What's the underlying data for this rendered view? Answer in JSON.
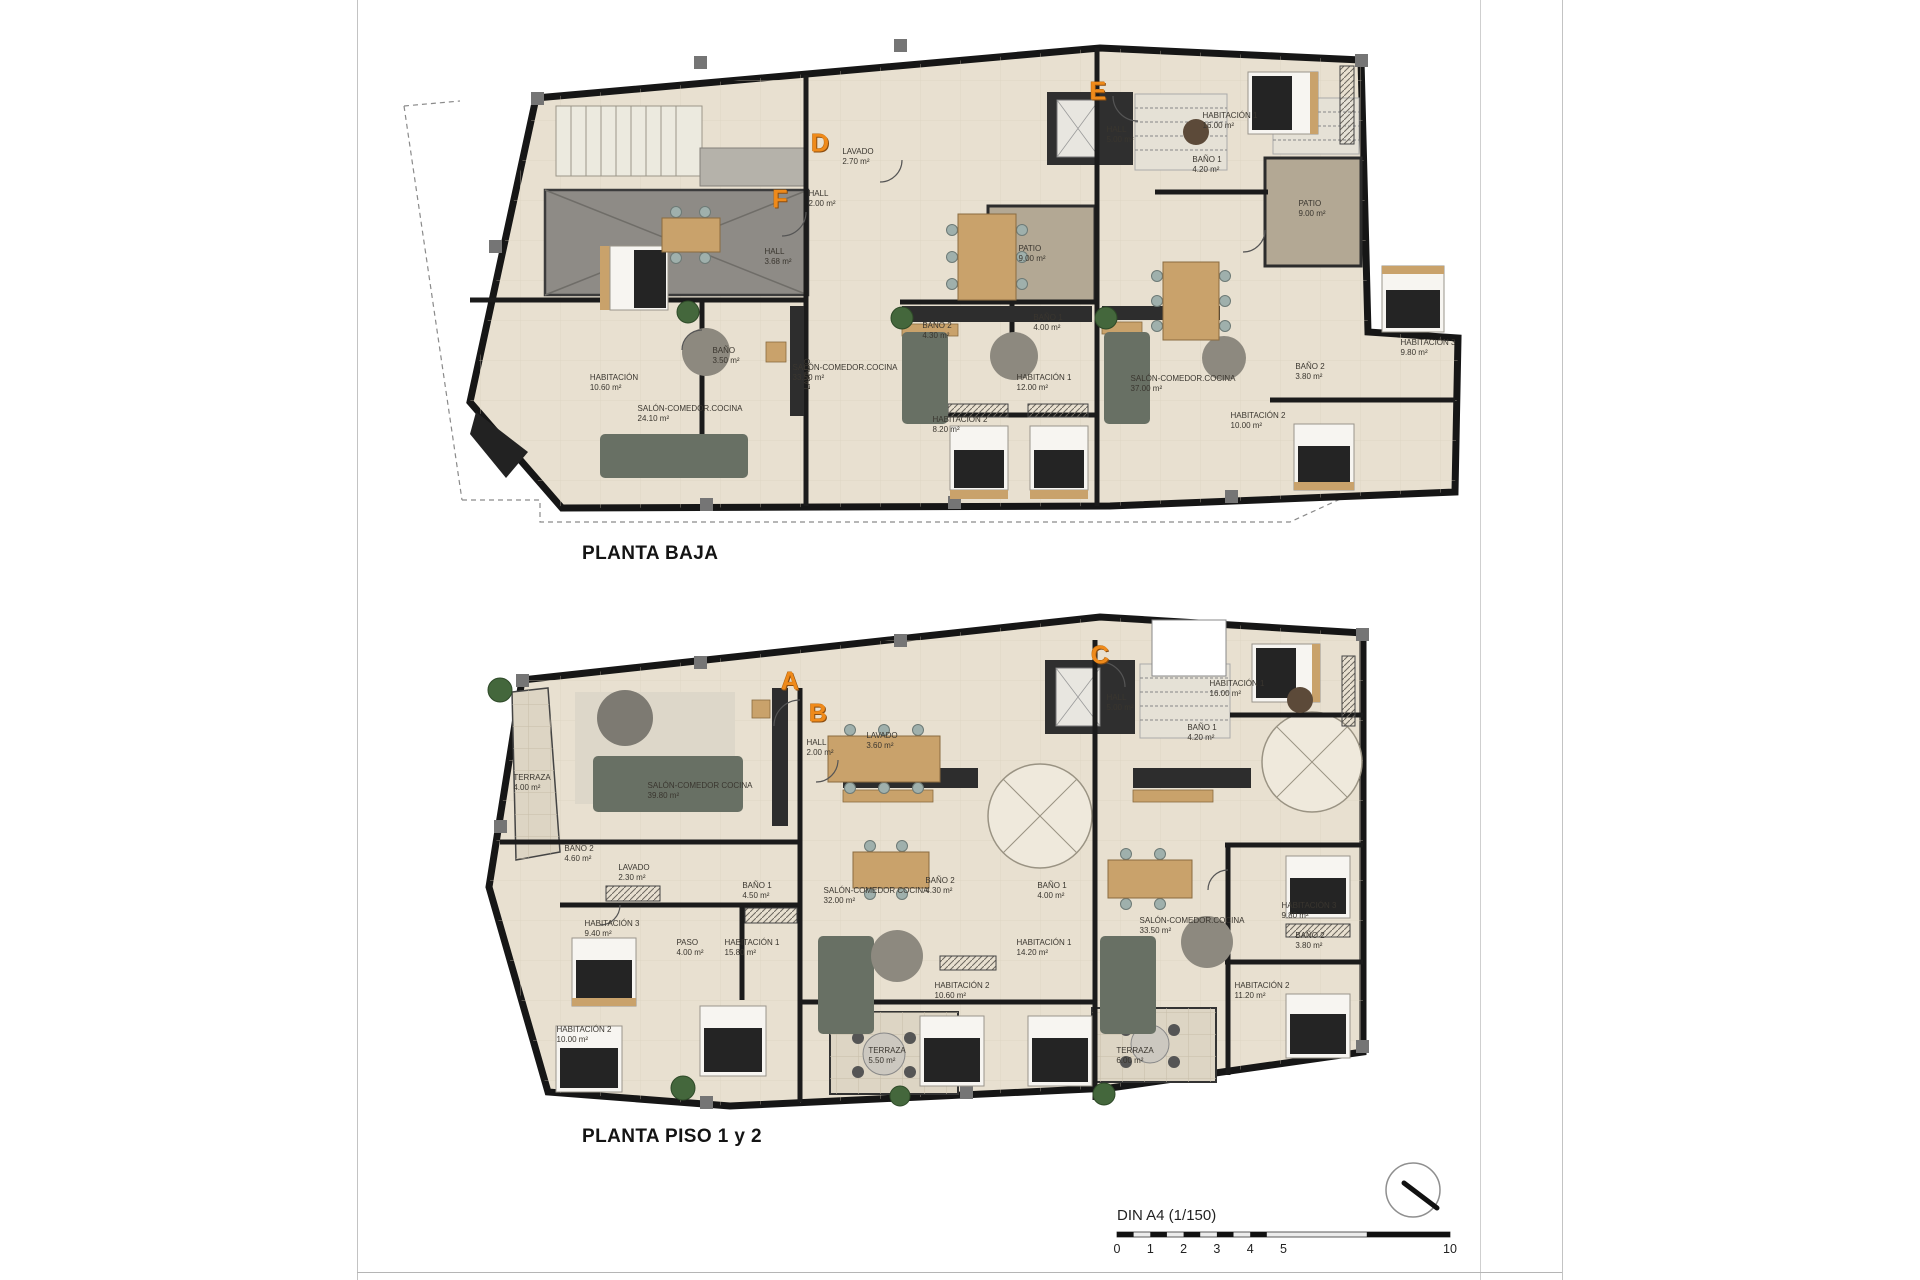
{
  "document": {
    "sections": [
      {
        "id": "planta-baja",
        "title": "PLANTA BAJA"
      },
      {
        "id": "planta-piso",
        "title": "PLANTA PISO 1 y 2"
      }
    ],
    "scale": {
      "label": "DIN A4 (1/150)",
      "ticks": [
        {
          "t": "0",
          "u": 0
        },
        {
          "t": "1",
          "u": 1
        },
        {
          "t": "2",
          "u": 2
        },
        {
          "t": "3",
          "u": 3
        },
        {
          "t": "4",
          "u": 4
        },
        {
          "t": "5",
          "u": 5
        },
        {
          "t": "10",
          "u": 10
        }
      ]
    },
    "colors": {
      "marker_orange": "#ef8a1a",
      "floor_beige": "#e8e0d0",
      "wall_dark": "#1b1b1b",
      "patio_tan": "#b3a894",
      "terrace_tile": "#ddd5c4",
      "garage_gray": "#8e8b86"
    }
  },
  "plans": [
    {
      "name": "planta-baja",
      "markers": [
        {
          "letter": "F",
          "x": 780,
          "y": 200
        },
        {
          "letter": "D",
          "x": 820,
          "y": 144
        },
        {
          "letter": "E",
          "x": 1098,
          "y": 92
        }
      ],
      "rooms": [
        {
          "name": "HALL",
          "area": "3.68 m²",
          "x": 778,
          "y": 257
        },
        {
          "name": "BAÑO",
          "area": "3.50 m²",
          "x": 726,
          "y": 356
        },
        {
          "name": "HABITACIÓN",
          "area": "10.60 m²",
          "x": 614,
          "y": 383
        },
        {
          "name": "SALÓN-COMEDOR.COCINA",
          "area": "24.10 m²",
          "x": 690,
          "y": 414
        },
        {
          "name": "LAVADO",
          "area": "",
          "x": 808,
          "y": 374,
          "v": true
        },
        {
          "name": "LAVADO",
          "area": "2.70 m²",
          "x": 858,
          "y": 157
        },
        {
          "name": "HALL",
          "area": "2.00 m²",
          "x": 822,
          "y": 199
        },
        {
          "name": "PATIO",
          "area": "9.00 m²",
          "x": 1032,
          "y": 254
        },
        {
          "name": "BAÑO 2",
          "area": "4.30 m²",
          "x": 937,
          "y": 331
        },
        {
          "name": "BAÑO 1",
          "area": "4.00 m²",
          "x": 1048,
          "y": 323
        },
        {
          "name": "SALÓN-COMEDOR.COCINA",
          "area": "33.50 m²",
          "x": 845,
          "y": 373
        },
        {
          "name": "HABITACIÓN 1",
          "area": "12.00 m²",
          "x": 1044,
          "y": 383
        },
        {
          "name": "HABITACIÓN 2",
          "area": "8.20 m²",
          "x": 960,
          "y": 425
        },
        {
          "name": "HALL",
          "area": "5.00 m²",
          "x": 1120,
          "y": 135
        },
        {
          "name": "HABITACIÓN 1",
          "area": "16.00 m²",
          "x": 1230,
          "y": 121
        },
        {
          "name": "BAÑO 1",
          "area": "4.20 m²",
          "x": 1207,
          "y": 165
        },
        {
          "name": "PATIO",
          "area": "9.00 m²",
          "x": 1312,
          "y": 209
        },
        {
          "name": "HABITACIÓN 3",
          "area": "9.80 m²",
          "x": 1428,
          "y": 348
        },
        {
          "name": "BAÑO 2",
          "area": "3.80 m²",
          "x": 1310,
          "y": 372
        },
        {
          "name": "SALÓN-COMEDOR.COCINA",
          "area": "37.00 m²",
          "x": 1183,
          "y": 384
        },
        {
          "name": "HABITACIÓN 2",
          "area": "10.00 m²",
          "x": 1258,
          "y": 421
        }
      ]
    },
    {
      "name": "planta-piso",
      "markers": [
        {
          "letter": "A",
          "x": 790,
          "y": 682
        },
        {
          "letter": "B",
          "x": 818,
          "y": 714
        },
        {
          "letter": "C",
          "x": 1100,
          "y": 656
        }
      ],
      "rooms": [
        {
          "name": "TERRAZA",
          "area": "4.00 m²",
          "x": 532,
          "y": 783
        },
        {
          "name": "SALÓN-COMEDOR COCINA",
          "area": "39.80 m²",
          "x": 700,
          "y": 791
        },
        {
          "name": "BAÑO 2",
          "area": "4.60 m²",
          "x": 579,
          "y": 854
        },
        {
          "name": "LAVADO",
          "area": "2.30 m²",
          "x": 634,
          "y": 873
        },
        {
          "name": "BAÑO 1",
          "area": "4.50 m²",
          "x": 757,
          "y": 891
        },
        {
          "name": "HABITACIÓN 3",
          "area": "9.40 m²",
          "x": 612,
          "y": 929
        },
        {
          "name": "PASO",
          "area": "4.00 m²",
          "x": 690,
          "y": 948
        },
        {
          "name": "HABITACIÓN 1",
          "area": "15.80 m²",
          "x": 752,
          "y": 948
        },
        {
          "name": "HABITACIÓN 2",
          "area": "10.00 m²",
          "x": 584,
          "y": 1035
        },
        {
          "name": "HALL",
          "area": "2.00 m²",
          "x": 820,
          "y": 748
        },
        {
          "name": "LAVADO",
          "area": "3.60 m²",
          "x": 882,
          "y": 741
        },
        {
          "name": "SALÓN-COMEDOR COCINA",
          "area": "32.00 m²",
          "x": 876,
          "y": 896
        },
        {
          "name": "BAÑO 2",
          "area": "4.30 m²",
          "x": 940,
          "y": 886
        },
        {
          "name": "BAÑO 1",
          "area": "4.00 m²",
          "x": 1052,
          "y": 891
        },
        {
          "name": "HABITACIÓN 1",
          "area": "14.20 m²",
          "x": 1044,
          "y": 948
        },
        {
          "name": "HABITACIÓN 2",
          "area": "10.60 m²",
          "x": 962,
          "y": 991
        },
        {
          "name": "TERRAZA",
          "area": "5.50 m²",
          "x": 887,
          "y": 1056
        },
        {
          "name": "HALL",
          "area": "5.00 m²",
          "x": 1120,
          "y": 703
        },
        {
          "name": "HABITACIÓN 1",
          "area": "16.00 m²",
          "x": 1237,
          "y": 689
        },
        {
          "name": "BAÑO 1",
          "area": "4.20 m²",
          "x": 1202,
          "y": 733
        },
        {
          "name": "SALÓN-COMEDOR.COCINA",
          "area": "33.50 m²",
          "x": 1192,
          "y": 926
        },
        {
          "name": "HABITACIÓN 3",
          "area": "9.80 m²",
          "x": 1309,
          "y": 911
        },
        {
          "name": "BAÑO 2",
          "area": "3.80 m²",
          "x": 1310,
          "y": 941
        },
        {
          "name": "HABITACIÓN 2",
          "area": "11.20 m²",
          "x": 1262,
          "y": 991
        },
        {
          "name": "TERRAZA",
          "area": "6.00 m²",
          "x": 1135,
          "y": 1056
        }
      ]
    }
  ]
}
